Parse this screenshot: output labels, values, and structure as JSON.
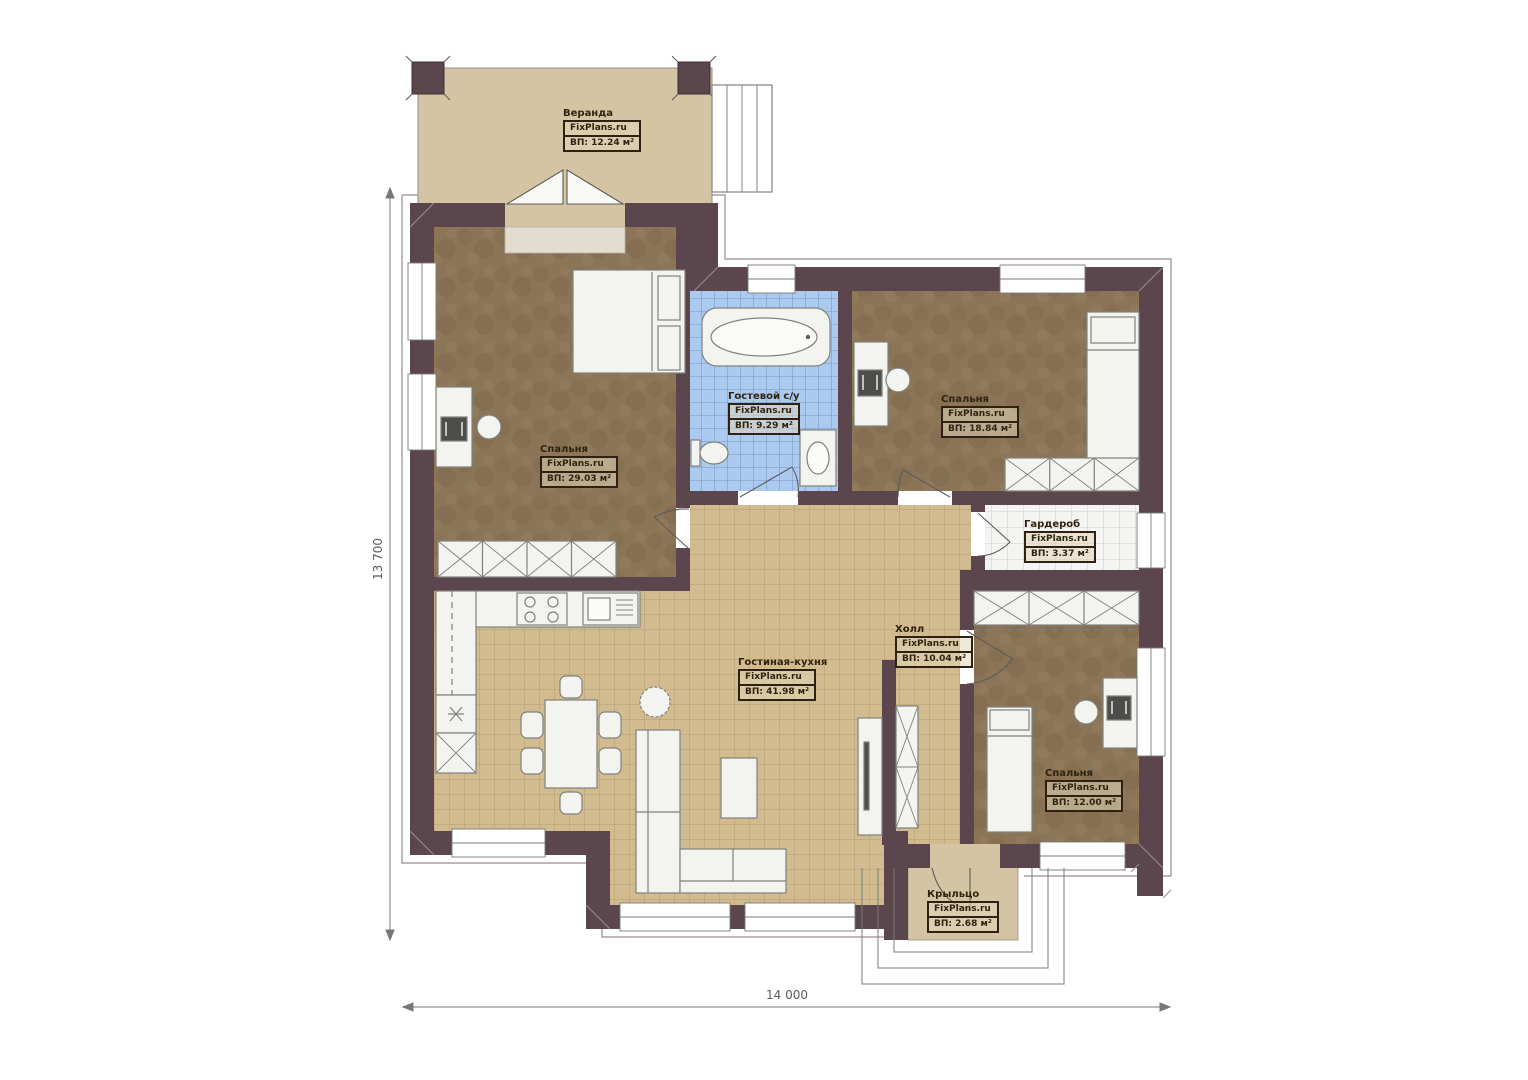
{
  "dimensions": {
    "height_label": "13 700",
    "width_label": "14 000"
  },
  "rooms": {
    "veranda": {
      "name": "Веранда",
      "brand": "FixPlans.ru",
      "area": "ВП: 12.24 м²"
    },
    "bedroom_left": {
      "name": "Спальня",
      "brand": "FixPlans.ru",
      "area": "ВП: 29.03 м²"
    },
    "bathroom": {
      "name": "Гостевой с/у",
      "brand": "FixPlans.ru",
      "area": "ВП: 9.29 м²"
    },
    "bedroom_right": {
      "name": "Спальня",
      "brand": "FixPlans.ru",
      "area": "ВП: 18.84 м²"
    },
    "wardrobe": {
      "name": "Гардероб",
      "brand": "FixPlans.ru",
      "area": "ВП: 3.37 м²"
    },
    "hall": {
      "name": "Холл",
      "brand": "FixPlans.ru",
      "area": "ВП: 10.04 м²"
    },
    "living_kitchen": {
      "name": "Гостиная-кухня",
      "brand": "FixPlans.ru",
      "area": "ВП: 41.98 м²"
    },
    "bedroom_small": {
      "name": "Спальня",
      "brand": "FixPlans.ru",
      "area": "ВП: 12.00 м²"
    },
    "porch": {
      "name": "Крыльцо",
      "brand": "FixPlans.ru",
      "area": "ВП: 2.68 м²"
    }
  },
  "colors": {
    "wall": "#5a464c",
    "tile_tan": "#d1bb8f",
    "tile_blue": "#accaef",
    "carpet": "#8c7557",
    "deck": "#d4c4a4"
  }
}
